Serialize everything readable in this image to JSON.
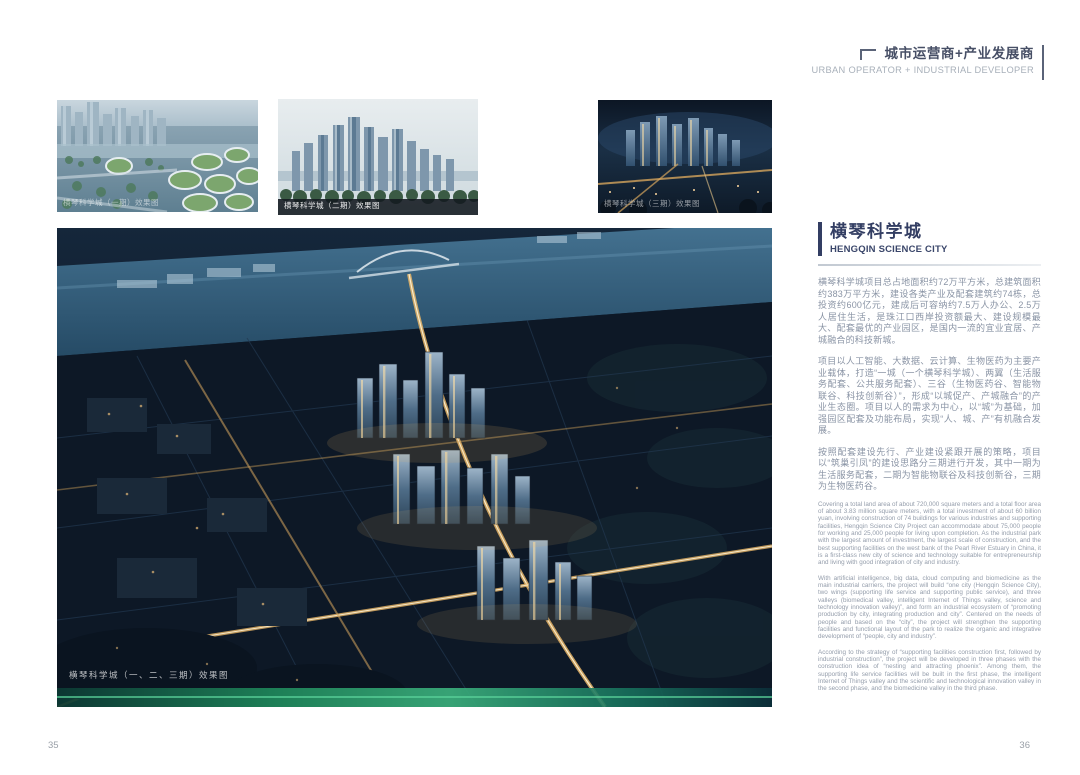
{
  "page": {
    "left_number": "35",
    "right_number": "36"
  },
  "header": {
    "title_cn": "城市运营商+产业发展商",
    "title_en": "URBAN OPERATOR + INDUSTRIAL DEVELOPER"
  },
  "gallery": {
    "thumbnails": [
      {
        "caption": "横琴科学城（一期）效果图"
      },
      {
        "caption": "横琴科学城（二期）效果图"
      },
      {
        "caption": "横琴科学城（三期）效果图"
      }
    ],
    "main_caption": "横琴科学城（一、二、三期）效果图"
  },
  "article": {
    "title_cn": "横琴科学城",
    "title_en": "HENGQIN SCIENCE CITY",
    "paragraphs_cn": [
      "横琴科学城项目总占地面积约72万平方米，总建筑面积约383万平方米，建设各类产业及配套建筑约74栋，总投资约600亿元，建成后可容纳约7.5万人办公、2.5万人居住生活，是珠江口西岸投资额最大、建设规模最大、配套最优的产业园区，是国内一流的宜业宜居、产城融合的科技新城。",
      "项目以人工智能、大数据、云计算、生物医药为主要产业载体，打造“一城（一个横琴科学城）、两翼（生活服务配套、公共服务配套）、三谷（生物医药谷、智能物联谷、科技创新谷）”，形成“以城促产、产城融合”的产业生态圈。项目以人的需求为中心，以“城”为基础，加强园区配套及功能布局，实现“人、城、产”有机融合发展。",
      "按照配套建设先行、产业建设紧跟开展的策略，项目以“筑巢引凤”的建设思路分三期进行开发，其中一期为生活服务配套，二期为智能物联谷及科技创新谷，三期为生物医药谷。"
    ],
    "paragraphs_en": [
      "Covering a total land area of about 720,000 square meters and a total floor area of about 3.83 million square meters, with a total investment of about 60 billion yuan, involving construction of 74 buildings for various industries and supporting facilities, Hengqin Science City Project can accommodate about 75,000 people for working and 25,000 people for living upon completion. As the industrial park with the largest amount of investment, the largest scale of construction, and the best supporting facilities on the west bank of the Pearl River Estuary in China, it is a first-class new city of science and technology suitable for entrepreneurship and living with good integration of city and industry.",
      "With artificial intelligence, big data, cloud computing and biomedicine as the main industrial carriers, the project will build “one city (Hengqin Science City), two wings (supporting life service and supporting public service), and three valleys (biomedical valley, intelligent Internet of Things valley, science and technology innovation valley)”, and form an industrial ecosystem of “promoting production by city, integrating production and city”. Centered on the needs of people and based on the “city”, the project will strengthen the supporting facilities and functional layout of the park to realize the organic and integrative development of “people, city and industry”.",
      "According to the strategy of “supporting facilities construction first, followed by industrial construction”, the project will be developed in three phases with the construction idea of “nesting and attracting phoenix”. Among them, the supporting life service facilities will be built in the first phase, the intelligent Internet of Things valley and the scientific and technological innovation valley in the second phase, and the biomedicine valley in the third phase."
    ]
  },
  "colors": {
    "accent_navy": "#333e63",
    "body_text_cn": "#8a94a5",
    "body_text_en": "#949dab",
    "header_text": "#474f66"
  }
}
